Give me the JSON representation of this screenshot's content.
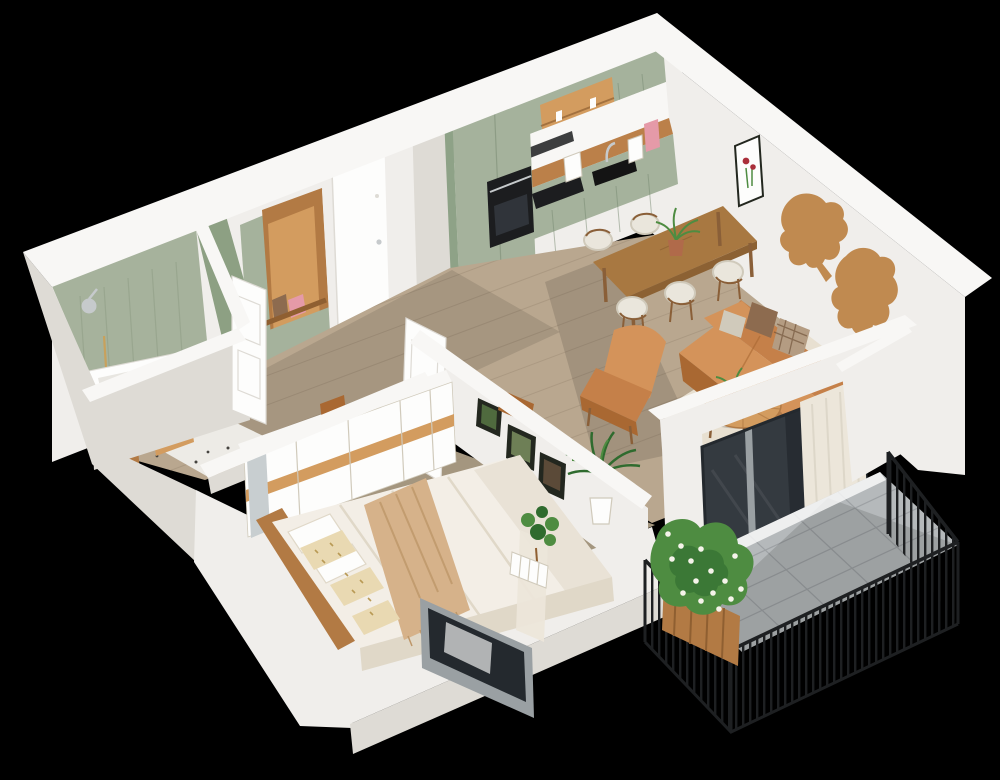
{
  "scene": {
    "description": "Isometric 3D cutaway floor plan render of a one-bedroom apartment on a black background",
    "rooms": [
      "bathroom",
      "entry hall",
      "kitchen",
      "dining area",
      "living room",
      "bedroom",
      "balcony"
    ],
    "objects": [
      "sage green kitchen cabinets",
      "wood countertop",
      "built-in oven",
      "induction cooktop",
      "black sink",
      "faucet",
      "kettle",
      "coffee machine",
      "open wood shelves",
      "dining table",
      "dining chairs",
      "potted plant",
      "wooden world map wall decor",
      "framed red flower artwork",
      "tan leather sofa",
      "plaid pillow",
      "brown pillow",
      "leather lounge chair",
      "round wood coffee table",
      "cream area rug",
      "potted palm",
      "fiddle leaf plant",
      "sliding glass balcony door",
      "cream curtain",
      "balcony with black metal railing",
      "gray tile balcony floor",
      "wood crate planter with daisies",
      "bed with white duvet",
      "beige throw blanket",
      "patterned pillows",
      "wood headboard",
      "white wardrobe with wood stripe",
      "mirror door",
      "gallery picture frames",
      "bedroom window",
      "green tiled bathroom walls",
      "bathtub",
      "terrazzo floor",
      "black basin vanity",
      "shower head",
      "entry niche with wood coat area",
      "pink bag",
      "front door",
      "bathroom door",
      "structural pillar"
    ]
  },
  "colors": {
    "bg": "#000000",
    "wallTop": "#f8f7f5",
    "wallLit": "#f0eeeb",
    "wallShade": "#dedbd5",
    "wallOuter": "#d4d1cb",
    "floorWood": "#b9a78f",
    "plank": "#9c8a73",
    "floorBedroom": "#a4967f",
    "terrazzo": "#edebe6",
    "speck": "#45433f",
    "tile": "#b5b9bb",
    "tileLine": "#9da1a4",
    "rail": "#1e2022",
    "greenLight": "#a6b29c",
    "greenMid": "#8da083",
    "greenDark": "#798a72",
    "cab": "#a5b29c",
    "cabSide": "#8ea287",
    "cabLine": "#76876f",
    "counter": "#bb8049",
    "woodBright": "#d39c5f",
    "wood": "#b27a44",
    "woodDark": "#8f5f31",
    "map": "#c08a50",
    "table": "#a87841",
    "tableSide": "#8c6133",
    "chair": "#eae6dc",
    "chairShade": "#d0cabb",
    "leg": "#8a5f38",
    "leather": "#c58049",
    "leatherLight": "#d4935a",
    "leatherDark": "#a96832",
    "pillowBrown": "#8d6b4f",
    "pillowPlaid": "#b49c82",
    "plaidLine": "#6e5138",
    "rug": "#e8e0d1",
    "duvet": "#f3eee6",
    "duvetShade": "#e0d8c8",
    "throw": "#d6b28a",
    "throwDark": "#bd9668",
    "pillowPat": "#e9d9b2",
    "patDot": "#b99a55",
    "white": "#fdfdfc",
    "black": "#141414",
    "appliance": "#1c1d1f",
    "steel": "#c6cacc",
    "frameGray": "#9aa0a3",
    "glass": "#343a40",
    "glassDark": "#24292e",
    "curtain": "#ece6da",
    "curtainLine": "#d8d1c3",
    "mirror": "#c8ced0",
    "green": "#4e8c41",
    "greenDeep": "#2f6b2e",
    "daisy": "#f5f3ea",
    "red": "#aa2f3a",
    "pink": "#e59aa8",
    "terracotta": "#b06a4a",
    "frame": "#23271f",
    "photo1": "#4f6a3e",
    "photo2": "#6e7f56",
    "photo3": "#5b4a38",
    "gold": "#c8a15c",
    "shadow": "#000000"
  }
}
